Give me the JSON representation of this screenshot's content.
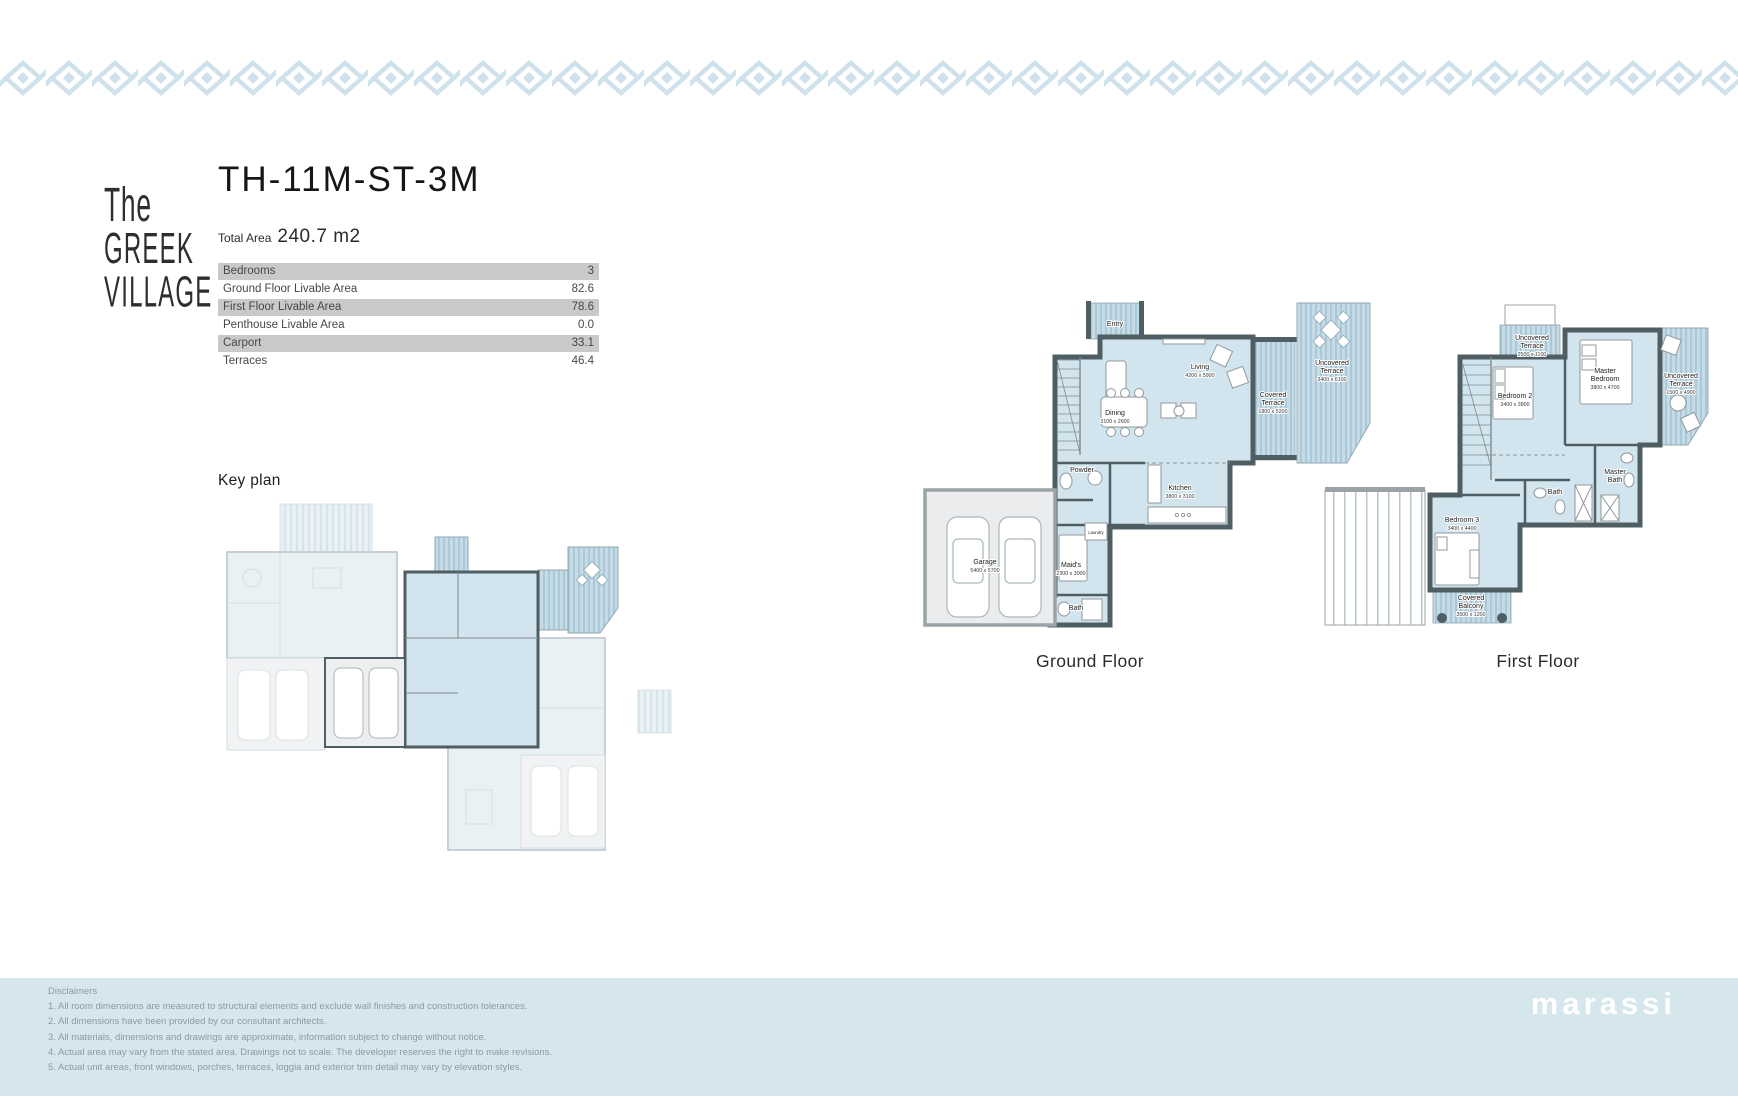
{
  "logo": {
    "line1": "The",
    "line2": "GREEK",
    "line3": "VILLAGE"
  },
  "unit": {
    "title": "TH-11M-ST-3M",
    "total_area_label": "Total Area",
    "total_area_value": "240.7 m2"
  },
  "area_table": {
    "rows": [
      {
        "label": "Bedrooms",
        "value": "3"
      },
      {
        "label": "Ground Floor Livable Area",
        "value": "82.6"
      },
      {
        "label": "First Floor Livable Area",
        "value": "78.6"
      },
      {
        "label": "Penthouse Livable Area",
        "value": "0.0"
      },
      {
        "label": "Carport",
        "value": "33.1"
      },
      {
        "label": "Terraces",
        "value": "46.4"
      }
    ]
  },
  "key_plan": {
    "label": "Key plan"
  },
  "ground_floor": {
    "caption": "Ground Floor",
    "rooms": {
      "entry": {
        "l1": "Entry"
      },
      "living": {
        "l1": "Living",
        "dim": "4200 x 5900"
      },
      "dining": {
        "l1": "Dining",
        "dim": "3100 x 2600"
      },
      "kitchen": {
        "l1": "Kitchen",
        "dim": "3800 x 3100"
      },
      "powder": {
        "l1": "Powder"
      },
      "laundry": {
        "l1": "Laundry"
      },
      "maids": {
        "l1": "Maid's",
        "dim": "2300 x 3000"
      },
      "bath": {
        "l1": "Bath"
      },
      "garage": {
        "l1": "Garage",
        "dim": "5400 x 5700"
      },
      "covered_terrace": {
        "l1": "Covered",
        "l2": "Terrace",
        "dim": "1800 x 5200"
      },
      "uncovered_terrace": {
        "l1": "Uncovered",
        "l2": "Terrace",
        "dim": "3400 x 6100"
      }
    }
  },
  "first_floor": {
    "caption": "First Floor",
    "rooms": {
      "uncovered_terrace_top": {
        "l1": "Uncovered",
        "l2": "Terrace",
        "dim": "2500 x 1100"
      },
      "bedroom2": {
        "l1": "Bedroom 2",
        "dim": "3400 x 3800"
      },
      "master_bedroom": {
        "l1": "Master",
        "l2": "Bedroom",
        "dim": "3800 x 4700"
      },
      "uncovered_terrace_right": {
        "l1": "Uncovered",
        "l2": "Terrace",
        "dim": "1500 x 4900"
      },
      "master_bath": {
        "l1": "Master",
        "l2": "Bath"
      },
      "bath": {
        "l1": "Bath"
      },
      "bedroom3": {
        "l1": "Bedroom 3",
        "dim": "3400 x 4400"
      },
      "covered_balcony": {
        "l1": "Covered",
        "l2": "Balcony",
        "dim": "3500 x 1200"
      }
    }
  },
  "footer": {
    "disclaimers_title": "Disclaimers",
    "items": [
      "1. All room dimensions are measured to structural elements and exclude wall finishes and construction tolerances.",
      "2. All dimensions have been provided by our consultant architects.",
      "3. All materials, dimensions and drawings are approximate, information subject to change without notice.",
      "4. Actual area may vary from the stated area. Drawings not to scale. The developer reserves the right to make revisions.",
      "5. Actual unit areas, front windows, porches, terraces, loggia and exterior trim detail may vary by elevation styles."
    ],
    "brand": "marassi"
  },
  "colors": {
    "border_pattern": "#cfe2ec",
    "plan_fill": "#d2e5ee",
    "wall": "#4e5e62",
    "stripe": "#a9c9d8",
    "footer_band": "#d5e6ec",
    "table_row_gray": "#c9c9c9"
  }
}
